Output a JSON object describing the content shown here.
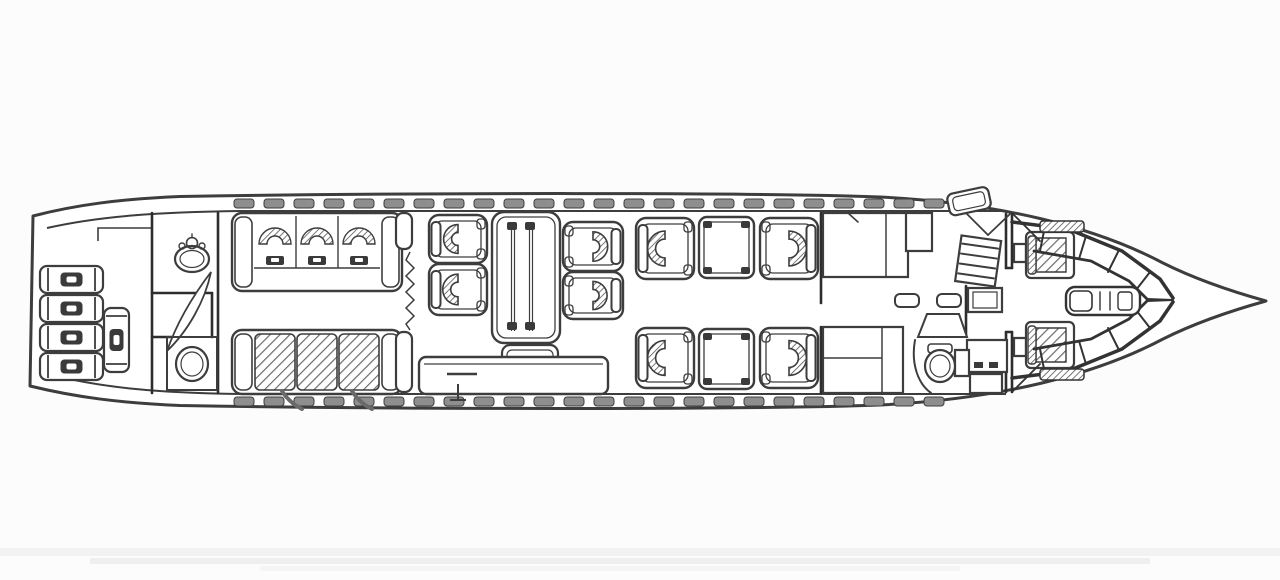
{
  "meta": {
    "title": "Aircraft cabin floor plan - executive jet interior line drawing, nose pointing right",
    "drawing_type": "scanned technical line drawing",
    "orientation": "nose-right"
  },
  "colors": {
    "background": "#fcfcfc",
    "line": "#3d3d3d",
    "line_dark": "#2d2d2d",
    "window_fill": "#8e8e8e",
    "hatch_stroke": "#606060",
    "belt_stroke": "#555555",
    "dark_fill": "#3a3a3a",
    "artifact": "#e6e6e6"
  },
  "canvas": {
    "width": 1280,
    "height": 580
  },
  "windows": {
    "top": {
      "y": 199,
      "width": 20,
      "height": 9,
      "xs": [
        234,
        264,
        294,
        324,
        354,
        384,
        414,
        444,
        474,
        504,
        534,
        564,
        594,
        624,
        654,
        684,
        714,
        744,
        774,
        804,
        834,
        864,
        894,
        924
      ]
    },
    "bottom": {
      "y": 397,
      "width": 20,
      "height": 9,
      "xs": [
        234,
        264,
        294,
        324,
        354,
        384,
        414,
        444,
        474,
        504,
        534,
        564,
        594,
        624,
        654,
        684,
        714,
        744,
        774,
        804,
        834,
        864,
        894,
        924
      ]
    }
  },
  "baggage": {
    "suitcases": [
      {
        "x": 40,
        "y": 266,
        "w": 63,
        "h": 27,
        "orient": "h"
      },
      {
        "x": 40,
        "y": 295,
        "w": 63,
        "h": 27,
        "orient": "h"
      },
      {
        "x": 40,
        "y": 324,
        "w": 63,
        "h": 27,
        "orient": "h"
      },
      {
        "x": 40,
        "y": 353,
        "w": 63,
        "h": 27,
        "orient": "h"
      },
      {
        "x": 104,
        "y": 308,
        "w": 25,
        "h": 64,
        "orient": "v"
      }
    ]
  },
  "walls": [
    [
      152,
      213,
      152,
      393
    ],
    [
      218,
      213,
      218,
      393
    ],
    [
      152,
      293,
      212,
      293
    ],
    [
      212,
      293,
      212,
      337
    ],
    [
      152,
      337,
      174,
      337
    ],
    [
      821,
      213,
      821,
      303
    ],
    [
      821,
      327,
      821,
      393
    ],
    [
      966,
      286,
      966,
      336
    ],
    [
      1006,
      214,
      1006,
      268
    ],
    [
      1012,
      214,
      1012,
      268
    ],
    [
      1006,
      268,
      1012,
      268
    ],
    [
      1006,
      332,
      1006,
      392
    ],
    [
      1012,
      332,
      1012,
      392
    ],
    [
      1006,
      332,
      1012,
      332
    ]
  ],
  "seating": {
    "divans": [
      {
        "id": "aft-divan-outboard",
        "x": 232,
        "y": 213,
        "w": 170,
        "h": 78,
        "places": 3,
        "style": "belts"
      },
      {
        "id": "aft-divan-inboard",
        "x": 232,
        "y": 330,
        "w": 170,
        "h": 64,
        "places": 3,
        "style": "hatched"
      }
    ],
    "chairs": [
      {
        "id": "dining-chair-aft-outboard",
        "x": 429,
        "y": 215,
        "w": 58,
        "h": 48,
        "facing": "right",
        "type": "dining"
      },
      {
        "id": "dining-chair-aft-inboard",
        "x": 429,
        "y": 264,
        "w": 58,
        "h": 51,
        "facing": "right",
        "type": "dining"
      },
      {
        "id": "dining-chair-fwd-outboard",
        "x": 563,
        "y": 222,
        "w": 60,
        "h": 49,
        "facing": "left",
        "type": "dining"
      },
      {
        "id": "dining-chair-fwd-inboard",
        "x": 563,
        "y": 272,
        "w": 60,
        "h": 47,
        "facing": "left",
        "type": "dining"
      },
      {
        "id": "club-chair-outboard-aft",
        "x": 636,
        "y": 218,
        "w": 58,
        "h": 61,
        "facing": "right",
        "type": "club"
      },
      {
        "id": "club-chair-outboard-fwd",
        "x": 760,
        "y": 218,
        "w": 58,
        "h": 61,
        "facing": "left",
        "type": "club"
      },
      {
        "id": "club-chair-inboard-aft",
        "x": 636,
        "y": 328,
        "w": 58,
        "h": 60,
        "facing": "right",
        "type": "club"
      },
      {
        "id": "club-chair-inboard-fwd",
        "x": 760,
        "y": 328,
        "w": 58,
        "h": 60,
        "facing": "left",
        "type": "club"
      }
    ],
    "pilot_seats": [
      {
        "id": "pilot-seat-left",
        "x": 1026,
        "y": 232,
        "w": 48,
        "h": 46
      },
      {
        "id": "pilot-seat-right",
        "x": 1026,
        "y": 322,
        "w": 48,
        "h": 46
      }
    ]
  },
  "tables": {
    "conference": {
      "x": 492,
      "y": 212,
      "w": 68,
      "h": 131
    },
    "pedestal": {
      "x": 502,
      "y": 345,
      "w": 56,
      "h": 47
    },
    "credenza": {
      "x": 419,
      "y": 357,
      "w": 189,
      "h": 37
    },
    "side_tables": [
      {
        "x": 699,
        "y": 217,
        "w": 55,
        "h": 61
      },
      {
        "x": 699,
        "y": 329,
        "w": 55,
        "h": 60
      }
    ]
  },
  "cabinets": [
    {
      "id": "wardrobe",
      "x": 823,
      "y": 213,
      "w": 85,
      "h": 64,
      "lines": [
        [
          886,
          213,
          886,
          277
        ]
      ]
    },
    {
      "id": "closet-small",
      "x": 906,
      "y": 213,
      "w": 26,
      "h": 38
    },
    {
      "id": "galley-counter",
      "x": 823,
      "y": 327,
      "w": 80,
      "h": 66,
      "lines": [
        [
          823,
          358,
          882,
          358
        ],
        [
          882,
          327,
          882,
          393
        ]
      ]
    },
    {
      "id": "galley-cabinet-upper",
      "x": 968,
      "y": 288,
      "w": 34,
      "h": 24,
      "inner": true
    },
    {
      "id": "galley-cabinet-lower",
      "x": 967,
      "y": 340,
      "w": 40,
      "h": 32,
      "handles": true
    },
    {
      "id": "galley-cabinet-base",
      "x": 970,
      "y": 374,
      "w": 32,
      "h": 19
    },
    {
      "id": "crew-stowage-box",
      "x": 955,
      "y": 350,
      "w": 14,
      "h": 26
    },
    {
      "id": "cockpit-console-aft",
      "x": 1014,
      "y": 244,
      "w": 12,
      "h": 18
    },
    {
      "id": "cockpit-console-fwd",
      "x": 1014,
      "y": 338,
      "w": 12,
      "h": 18
    }
  ],
  "galley_items": [
    {
      "x": 895,
      "y": 294,
      "w": 24,
      "h": 13
    },
    {
      "x": 937,
      "y": 294,
      "w": 24,
      "h": 13
    }
  ],
  "inventory": {
    "divans": 2,
    "divan_places": 6,
    "dining_chairs": 4,
    "club_chairs": 4,
    "passenger_seats_total": 14,
    "crew_seats": 2,
    "lavatories": 2,
    "side_tables": 2,
    "conference_tables": 1,
    "baggage_items": 5,
    "cabin_windows_per_side": 24
  },
  "sections": [
    {
      "id": "aft-baggage-compartment",
      "x_range": [
        30,
        152
      ]
    },
    {
      "id": "aft-lavatory",
      "x_range": [
        152,
        218
      ]
    },
    {
      "id": "aft-lounge-divans",
      "x_range": [
        218,
        413
      ]
    },
    {
      "id": "conference-dining-group",
      "x_range": [
        413,
        630
      ]
    },
    {
      "id": "club-seating-group",
      "x_range": [
        630,
        821
      ]
    },
    {
      "id": "galley-entry-area",
      "x_range": [
        821,
        1006
      ]
    },
    {
      "id": "cockpit",
      "x_range": [
        1006,
        1273
      ]
    }
  ]
}
